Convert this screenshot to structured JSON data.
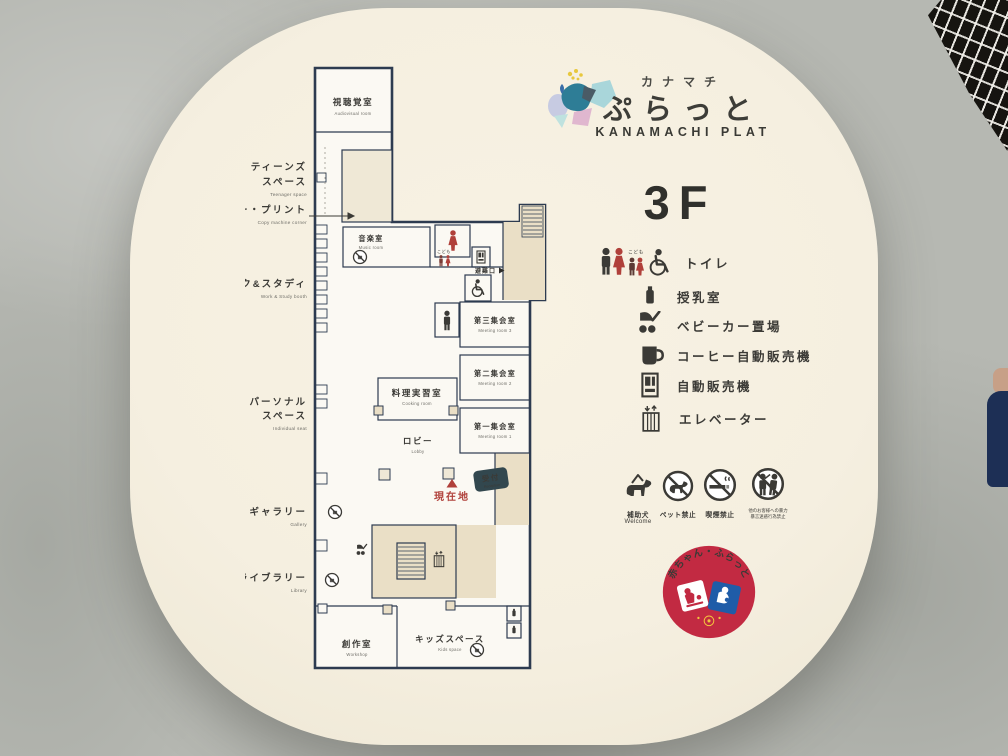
{
  "brand": {
    "katakana": "カナマチ",
    "name": "ぷらっと",
    "romaji": "KANAMACHI PLAT"
  },
  "floor_label": "3F",
  "legend": {
    "toilet": {
      "label": "トイレ",
      "child_label": "こども"
    },
    "nursing": {
      "label": "授乳室"
    },
    "stroller": {
      "label": "ベビーカー置場"
    },
    "coffee": {
      "label": "コーヒー自動販売機"
    },
    "vending": {
      "label": "自動販売機"
    },
    "elevator": {
      "label": "エレベーター"
    }
  },
  "rules": {
    "assist_dog": {
      "jp": "補助犬",
      "en": "Welcome"
    },
    "no_pets": {
      "jp": "ペット禁止"
    },
    "no_smoking": {
      "jp": "喫煙禁止"
    },
    "no_violence": {
      "line1": "他のお客様への暴力",
      "line2": "暴言迷惑行為禁止"
    }
  },
  "badge": {
    "text": "赤ちゃん・ふらっと"
  },
  "map": {
    "rooms": {
      "audiovisual": {
        "jp": "視聴覚室",
        "en": "Audiovisual room"
      },
      "teens": {
        "jp1": "ティーンズ",
        "jp2": "スペース",
        "en": "Teenager space"
      },
      "copy": {
        "jp": "コピー・プリント",
        "en": "Copy machine corner"
      },
      "music": {
        "jp": "音楽室",
        "en": "Music room"
      },
      "workstudy": {
        "jp": "ワーク&スタディ",
        "en": "Work & Study booth"
      },
      "personal": {
        "jp1": "パーソナル",
        "jp2": "スペース",
        "en": "Individual seat"
      },
      "gallery": {
        "jp": "ギャラリー",
        "en": "Gallery"
      },
      "library": {
        "jp": "ライブラリー",
        "en": "Library"
      },
      "workshop": {
        "jp": "創作室",
        "en": "Workshop"
      },
      "kids": {
        "jp": "キッズスペース",
        "en": "Kids space"
      },
      "cooking": {
        "jp": "料理実習室",
        "en": "Cooking room"
      },
      "lobby": {
        "jp": "ロビー",
        "en": "Lobby"
      },
      "meeting3": {
        "jp": "第三集会室",
        "en": "Meeting room 3"
      },
      "meeting2": {
        "jp": "第二集会室",
        "en": "Meeting room 2"
      },
      "meeting1": {
        "jp": "第一集会室",
        "en": "Meeting room 1"
      }
    },
    "markers": {
      "reception_jp": "受付",
      "reception_en": "Reception",
      "you_are_here": "現在地",
      "emergency_exit": "避難口",
      "child": "こども"
    }
  },
  "colors": {
    "sign_cream": "#f5efe0",
    "plan_line": "#2d3b50",
    "accent_red": "#b0403a",
    "reception_teal": "#32474e",
    "badge_red": "#c22a42",
    "badge_blue": "#1f5ca8",
    "badge_yellow": "#f3c53d"
  }
}
